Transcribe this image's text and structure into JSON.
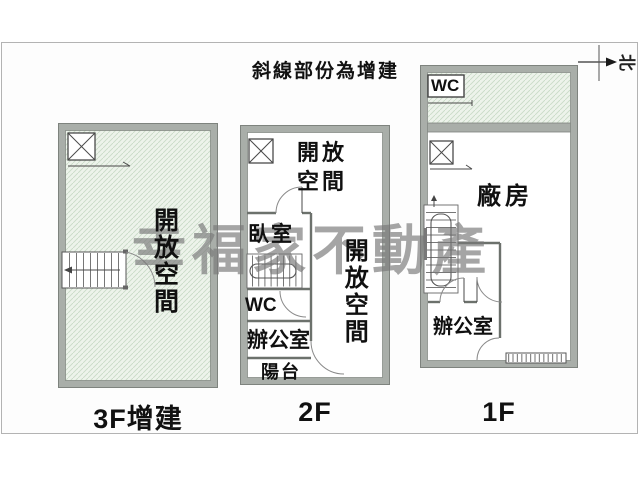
{
  "header": {
    "note": "斜線部份為增建",
    "compass": "北"
  },
  "watermark": "幸福家不動產",
  "floors": {
    "f3": {
      "label": "3F增建",
      "open_space": "開放空間"
    },
    "f2": {
      "label": "2F",
      "open_space_upper": "開放空間",
      "bedroom": "臥室",
      "wc": "WC",
      "office": "辦公室",
      "balcony": "陽台",
      "open_space_right": "開放空間"
    },
    "f1": {
      "label": "1F",
      "wc": "WC",
      "factory": "廠房",
      "office": "辦公室"
    }
  },
  "colors": {
    "wall": "#a9aea9",
    "wall_edge": "#7e837e",
    "hatch_bg": "#edf3eb",
    "hatch_line": "#c9dbc7",
    "watermark": "#787878",
    "text": "#111111"
  }
}
